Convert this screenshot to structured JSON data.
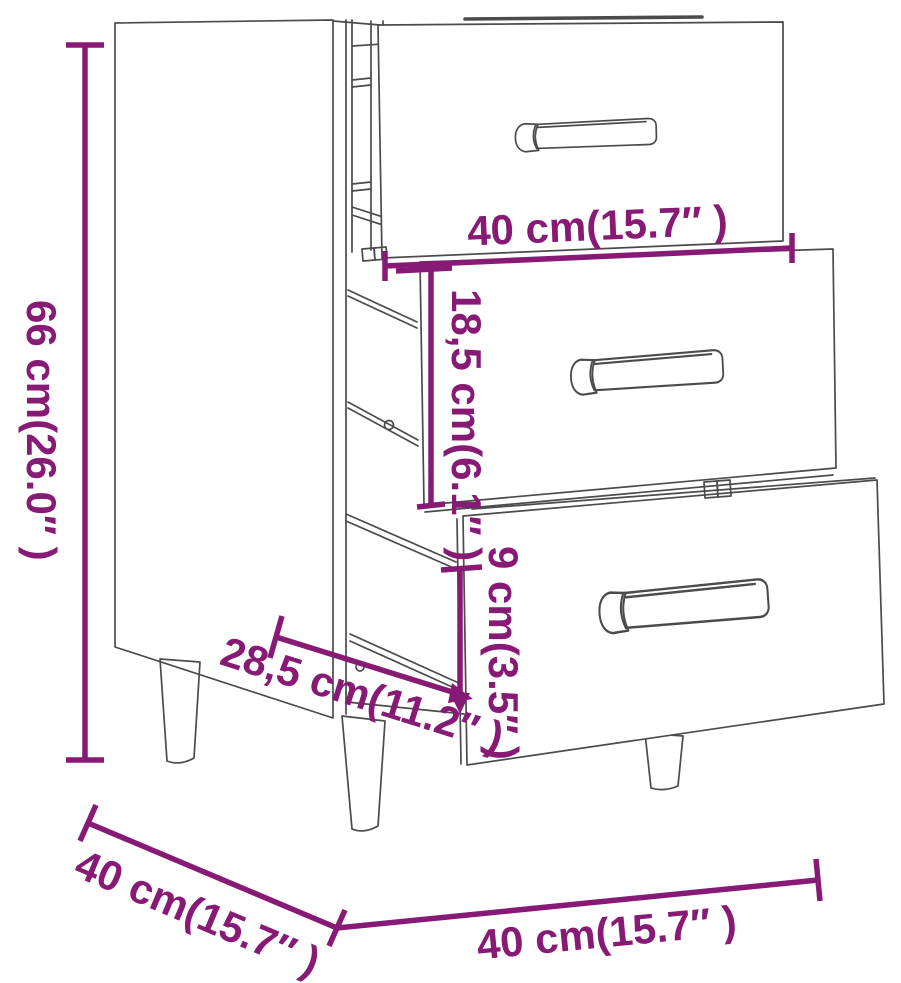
{
  "diagram": {
    "type": "furniture-dimension-line-drawing",
    "subject": "bedside cabinet with three drawers",
    "colors": {
      "dimension_accent": "#871a75",
      "line_art": "#4b4b4b",
      "background": "#ffffff"
    },
    "dimensions": {
      "overall_height": {
        "label": "66 cm(26.0″ )"
      },
      "drawer_width": {
        "label": "40 cm(15.7″ )"
      },
      "middle_drawer_height": {
        "label": "18,5 cm(6.1″ )"
      },
      "lower_gap_height": {
        "label": "9 cm(3.5″ )"
      },
      "internal_depth": {
        "label": "28,5 cm(11.2″ )"
      },
      "overall_depth": {
        "label": "40 cm(15.7″ )"
      },
      "overall_width": {
        "label": "40 cm(15.7″ )"
      }
    }
  }
}
